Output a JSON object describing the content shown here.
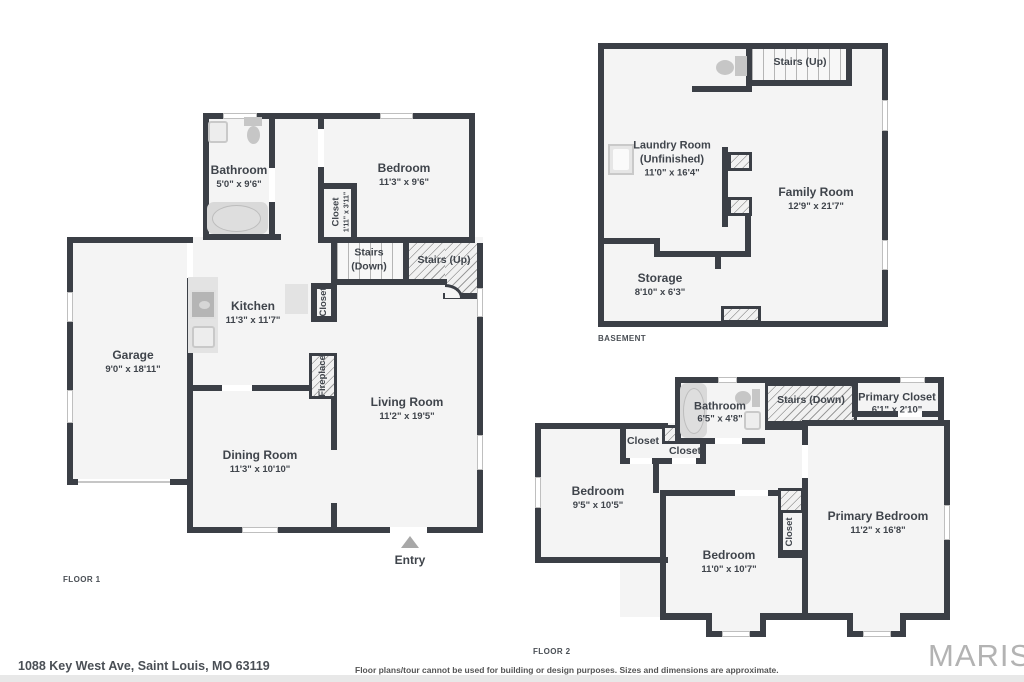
{
  "floor1": {
    "tag": "FLOOR 1",
    "rooms": {
      "bathroom": {
        "name": "Bathroom",
        "dims": "5'0\" x 9'6\""
      },
      "bedroom": {
        "name": "Bedroom",
        "dims": "11'3\" x 9'6\""
      },
      "closet_bedroom": {
        "name": "Closet",
        "dims": "1'11\" x 3'11\""
      },
      "stairs_down": {
        "name": "Stairs (Down)"
      },
      "stairs_up": {
        "name": "Stairs (Up)"
      },
      "kitchen": {
        "name": "Kitchen",
        "dims": "11'3\" x 11'7\""
      },
      "closet_hall": {
        "name": "Closet"
      },
      "fireplace": {
        "name": "Fireplace"
      },
      "garage": {
        "name": "Garage",
        "dims": "9'0\" x 18'11\""
      },
      "dining": {
        "name": "Dining Room",
        "dims": "11'3\" x 10'10\""
      },
      "living": {
        "name": "Living Room",
        "dims": "11'2\" x 19'5\""
      },
      "entry": {
        "name": "Entry"
      }
    }
  },
  "basement": {
    "tag": "BASEMENT",
    "rooms": {
      "stairs_up": {
        "name": "Stairs (Up)"
      },
      "laundry": {
        "name": "Laundry Room",
        "name2": "(Unfinished)",
        "dims": "11'0\" x 16'4\""
      },
      "family": {
        "name": "Family Room",
        "dims": "12'9\" x 21'7\""
      },
      "storage": {
        "name": "Storage",
        "dims": "8'10\" x 6'3\""
      }
    }
  },
  "floor2": {
    "tag": "FLOOR 2",
    "rooms": {
      "bathroom": {
        "name": "Bathroom",
        "dims": "6'5\" x 4'8\""
      },
      "stairs_down": {
        "name": "Stairs (Down)"
      },
      "primary_closet": {
        "name": "Primary Closet",
        "dims": "6'1\" x 2'10\""
      },
      "closet_a": {
        "name": "Closet"
      },
      "closet_b": {
        "name": "Closet"
      },
      "bedroom_left": {
        "name": "Bedroom",
        "dims": "9'5\" x 10'5\""
      },
      "bedroom_mid": {
        "name": "Bedroom",
        "dims": "11'0\" x 10'7\""
      },
      "closet_mid": {
        "name": "Closet"
      },
      "primary_bedroom": {
        "name": "Primary Bedroom",
        "dims": "11'2\" x 16'8\""
      }
    }
  },
  "footer": {
    "address": "1088 Key West Ave, Saint Louis, MO 63119",
    "disclaimer": "Floor plans/tour cannot be used for building or design purposes. Sizes and dimensions are approximate.",
    "brand": "MARIS"
  },
  "colors": {
    "wall": "#3b3f46",
    "room_fill": "#f4f4f4",
    "text": "#3f444b",
    "brand_gray": "#b3b3b3"
  }
}
